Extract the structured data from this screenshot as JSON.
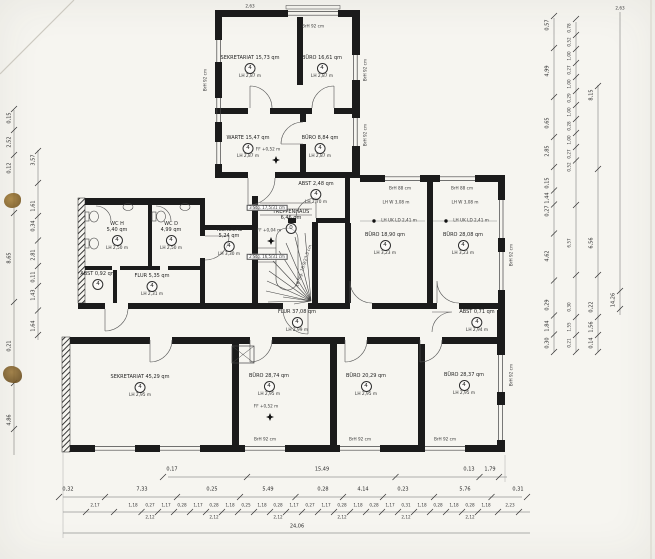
{
  "colors": {
    "paper": "#f6f5f0",
    "wall": "#1b1b1b",
    "thin_line": "#444444",
    "dim_line": "#555555",
    "stain": "#8a6a2c"
  },
  "rooms": [
    {
      "t": "SEKRETARIAT 15,73 qm",
      "n": "4",
      "lh": "LH 2,87 m",
      "x": 250,
      "y": 56
    },
    {
      "t": "BÜRO 16,61 qm",
      "n": "4",
      "lh": "LH 2,87 m",
      "x": 322,
      "y": 56
    },
    {
      "t": "WARTE 15,47 qm",
      "n": "4",
      "lh": "LH 2,87 m",
      "x": 248,
      "y": 136
    },
    {
      "t": "BÜRO 8,84 qm",
      "n": "4",
      "lh": "LH 2,87 m",
      "x": 320,
      "y": 136
    },
    {
      "t": "ABST 2,48 qm",
      "n": "4",
      "lh": "LH 2,70 m",
      "x": 316,
      "y": 182
    },
    {
      "t": "TEEKÜCHE",
      "t2": "5,24 qm",
      "n": "4",
      "lh": "LH 3,30 m",
      "x": 229,
      "y": 228
    },
    {
      "t": "TREPPENHAUS",
      "t2": "6,46 qm",
      "n": "0",
      "lh": "",
      "x": 291,
      "y": 210
    },
    {
      "t": "WC H",
      "t2": "5,40 qm",
      "n": "4",
      "lh": "LH 2,50 m",
      "x": 117,
      "y": 222
    },
    {
      "t": "WC D",
      "t2": "4,99 qm",
      "n": "4",
      "lh": "LH 2,50 m",
      "x": 171,
      "y": 222
    },
    {
      "t": "ABST 0,92 qm",
      "n": "4",
      "lh": "",
      "x": 98,
      "y": 272
    },
    {
      "t": "FLUR 5,35 qm",
      "n": "4",
      "lh": "LH 2,31 m",
      "x": 152,
      "y": 274
    },
    {
      "t": "FLUR 37,08 qm",
      "n": "4",
      "lh": "LH 2,99 m",
      "x": 297,
      "y": 310
    },
    {
      "t": "BÜRO 18,90 qm",
      "n": "4",
      "lh": "LH 3,23 m",
      "x": 385,
      "y": 233
    },
    {
      "t": "BÜRO 28,08 qm",
      "n": "4",
      "lh": "LH 3,23 m",
      "x": 463,
      "y": 233
    },
    {
      "t": "SEKRETARIAT 45,29 qm",
      "n": "4",
      "lh": "LH 2,95 m",
      "x": 140,
      "y": 375
    },
    {
      "t": "BÜRO 28,74 qm",
      "n": "4",
      "lh": "LH 2,95 m",
      "x": 269,
      "y": 374
    },
    {
      "t": "BÜRO 20,29 qm",
      "n": "4",
      "lh": "LH 2,95 m",
      "x": 366,
      "y": 374
    },
    {
      "t": "BÜRO 28,37 qm",
      "n": "4",
      "lh": "LH 2,95 m",
      "x": 464,
      "y": 373
    },
    {
      "t": "ABST 0,71 qm",
      "n": "4",
      "lh": "LH 2,94 m",
      "x": 477,
      "y": 310
    }
  ],
  "annotations": [
    {
      "t": "FF +0,52 m",
      "x": 268,
      "y": 150
    },
    {
      "t": "FF +0,04 m",
      "x": 269,
      "y": 231
    },
    {
      "t": "FF +0,52 m",
      "x": 266,
      "y": 407
    },
    {
      "t": "3 Stg. 17,5/31 cm",
      "x": 267,
      "y": 208,
      "box": true
    },
    {
      "t": "2 Stg. 16,5/31 cm",
      "x": 267,
      "y": 257,
      "box": true
    },
    {
      "t": "18 Stg. 16,9/23,5 cm",
      "x": 304,
      "y": 266,
      "rot": -72
    },
    {
      "t": "BrH 92 cm",
      "x": 313,
      "y": 27
    },
    {
      "t": "BrH 92 cm",
      "x": 206,
      "y": 80,
      "rot": -90
    },
    {
      "t": "BrH 92 cm",
      "x": 366,
      "y": 70,
      "rot": -90
    },
    {
      "t": "BrH 92 cm",
      "x": 366,
      "y": 135,
      "rot": -90
    },
    {
      "t": "BrH 88 cm",
      "x": 400,
      "y": 189
    },
    {
      "t": "BrH 88 cm",
      "x": 462,
      "y": 189
    },
    {
      "t": "LH W 3,08 m",
      "x": 396,
      "y": 203
    },
    {
      "t": "LH W 3,08 m",
      "x": 465,
      "y": 203
    },
    {
      "t": "LH UK LD 2,41 m",
      "x": 399,
      "y": 221
    },
    {
      "t": "LH UK LD 2,41 m",
      "x": 471,
      "y": 221
    },
    {
      "t": "BrH 92 cm",
      "x": 265,
      "y": 440
    },
    {
      "t": "BrH 92 cm",
      "x": 360,
      "y": 440
    },
    {
      "t": "BrH 92 cm",
      "x": 445,
      "y": 440
    },
    {
      "t": "BrH 92 cm",
      "x": 512,
      "y": 375,
      "rot": -90
    },
    {
      "t": "BrH 92 cm",
      "x": 512,
      "y": 255,
      "rot": -90
    },
    {
      "t": "2,63",
      "x": 250,
      "y": 7
    },
    {
      "t": "2,63",
      "x": 620,
      "y": 9
    }
  ],
  "dims": {
    "bottom_row1": [
      {
        "t": "0,17",
        "x": 172
      },
      {
        "t": "15,49",
        "x": 322
      },
      {
        "t": "0,13",
        "x": 469
      },
      {
        "t": "1,79",
        "x": 490
      }
    ],
    "bottom_row2": [
      {
        "t": "0,32",
        "x": 68
      },
      {
        "t": "7,33",
        "x": 142
      },
      {
        "t": "0,25",
        "x": 212
      },
      {
        "t": "5,49",
        "x": 268
      },
      {
        "t": "0,28",
        "x": 323
      },
      {
        "t": "4,14",
        "x": 363
      },
      {
        "t": "0,23",
        "x": 403
      },
      {
        "t": "5,76",
        "x": 465
      },
      {
        "t": "0,31",
        "x": 518
      }
    ],
    "bottom_row3a": [
      {
        "t": "2,17",
        "x": 95
      },
      {
        "t": "1,18",
        "x": 133
      },
      {
        "t": "0,27",
        "x": 150
      },
      {
        "t": "1,17",
        "x": 166
      },
      {
        "t": "0,28",
        "x": 182
      },
      {
        "t": "1,17",
        "x": 198
      },
      {
        "t": "0,28",
        "x": 214
      },
      {
        "t": "1,18",
        "x": 230
      },
      {
        "t": "0,25",
        "x": 246
      },
      {
        "t": "1,18",
        "x": 262
      },
      {
        "t": "0,28",
        "x": 278
      },
      {
        "t": "1,17",
        "x": 294
      },
      {
        "t": "0,27",
        "x": 310
      },
      {
        "t": "1,17",
        "x": 326
      },
      {
        "t": "0,28",
        "x": 342
      },
      {
        "t": "1,18",
        "x": 358
      },
      {
        "t": "0,28",
        "x": 374
      },
      {
        "t": "1,17",
        "x": 390
      },
      {
        "t": "0,31",
        "x": 406
      },
      {
        "t": "1,18",
        "x": 422
      },
      {
        "t": "0,28",
        "x": 438
      },
      {
        "t": "1,18",
        "x": 454
      },
      {
        "t": "0,28",
        "x": 470
      },
      {
        "t": "1,18",
        "x": 486
      },
      {
        "t": "2,23",
        "x": 510
      }
    ],
    "bottom_row3b": [
      {
        "t": "2,12",
        "x": 150
      },
      {
        "t": "2,12",
        "x": 214
      },
      {
        "t": "2,12",
        "x": 278
      },
      {
        "t": "2,12",
        "x": 342
      },
      {
        "t": "2,12",
        "x": 406
      },
      {
        "t": "2,12",
        "x": 470
      }
    ],
    "bottom_row4": [
      {
        "t": "24,06",
        "x": 297
      }
    ],
    "left_outer": [
      {
        "t": "0,15",
        "y": 118
      },
      {
        "t": "2,52",
        "y": 142
      },
      {
        "t": "0,12",
        "y": 168
      },
      {
        "t": "8,65",
        "y": 258
      },
      {
        "t": "0,21",
        "y": 346
      },
      {
        "t": "4,86",
        "y": 420
      }
    ],
    "left_inner": [
      {
        "t": "3,57",
        "y": 160
      },
      {
        "t": "1,61",
        "y": 206
      },
      {
        "t": "0,34",
        "y": 226
      },
      {
        "t": "2,81",
        "y": 255
      },
      {
        "t": "0,11",
        "y": 277
      },
      {
        "t": "1,43",
        "y": 295
      },
      {
        "t": "1,64",
        "y": 326
      }
    ],
    "right_c1": [
      {
        "t": "0,57",
        "y": 25
      },
      {
        "t": "4,99",
        "y": 71
      },
      {
        "t": "0,65",
        "y": 123
      },
      {
        "t": "2,85",
        "y": 151
      },
      {
        "t": "0,15",
        "y": 183
      },
      {
        "t": "1,44",
        "y": 198
      },
      {
        "t": "0,27",
        "y": 211
      },
      {
        "t": "4,62",
        "y": 256
      },
      {
        "t": "0,29",
        "y": 305
      },
      {
        "t": "1,84",
        "y": 326
      },
      {
        "t": "0,30",
        "y": 343
      }
    ],
    "right_c2": [
      {
        "t": "0,78",
        "y": 28
      },
      {
        "t": "0,52",
        "y": 42
      },
      {
        "t": "1,00",
        "y": 56
      },
      {
        "t": "0,27",
        "y": 70
      },
      {
        "t": "1,00",
        "y": 84
      },
      {
        "t": "0,29",
        "y": 98
      },
      {
        "t": "1,00",
        "y": 112
      },
      {
        "t": "0,28",
        "y": 126
      },
      {
        "t": "1,00",
        "y": 140
      },
      {
        "t": "0,27",
        "y": 154
      },
      {
        "t": "0,52",
        "y": 167
      },
      {
        "t": "6,57",
        "y": 243
      },
      {
        "t": "0,30",
        "y": 307
      },
      {
        "t": "1,55",
        "y": 327
      },
      {
        "t": "0,21",
        "y": 343
      }
    ],
    "right_c3": [
      {
        "t": "8,15",
        "y": 95
      },
      {
        "t": "6,56",
        "y": 243
      },
      {
        "t": "0,22",
        "y": 307
      },
      {
        "t": "1,56",
        "y": 327
      },
      {
        "t": "0,14",
        "y": 343
      }
    ],
    "right_c4": [
      {
        "t": "14,26",
        "y": 300
      }
    ]
  }
}
